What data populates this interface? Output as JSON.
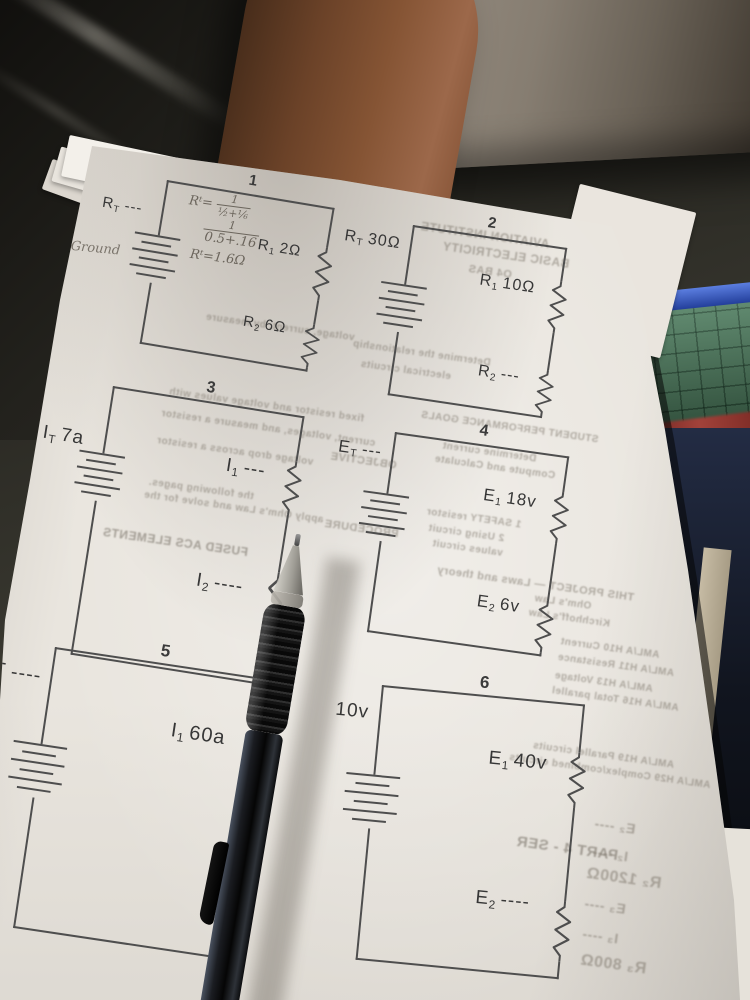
{
  "page": {
    "circuits": [
      {
        "number": "1",
        "left_label": {
          "base": "R",
          "sub": "T",
          "val": "---"
        },
        "top_resistor": {
          "base": "R",
          "sub": "1",
          "val": "2Ω"
        },
        "bottom_resistor": {
          "base": "R",
          "sub": "2",
          "val": "6Ω"
        },
        "handwriting": {
          "line1_lhs": "Rᵗ=",
          "frac1_num": "1",
          "frac1_den": "½+⅙",
          "frac2_num": "1",
          "frac2_den": "0.5+.16",
          "result": "Rᵗ=1.6Ω",
          "ground_note": "Ground"
        }
      },
      {
        "number": "2",
        "left_label": {
          "base": "R",
          "sub": "T",
          "val": "30Ω"
        },
        "top_resistor": {
          "base": "R",
          "sub": "1",
          "val": "10Ω"
        },
        "bottom_resistor": {
          "base": "R",
          "sub": "2",
          "val": "---"
        }
      },
      {
        "number": "3",
        "left_label": {
          "base": "I",
          "sub": "T",
          "val": "7a"
        },
        "top_resistor": {
          "base": "I",
          "sub": "1",
          "val": "---"
        },
        "bottom_resistor": {
          "base": "I",
          "sub": "2",
          "val": "----"
        }
      },
      {
        "number": "4",
        "left_label": {
          "base": "E",
          "sub": "T",
          "val": "---"
        },
        "top_resistor": {
          "base": "E",
          "sub": "1",
          "val": "18v"
        },
        "bottom_resistor": {
          "base": "E",
          "sub": "2",
          "val": "6v"
        }
      },
      {
        "number": "5",
        "left_label": {
          "base": "T",
          "sub": "",
          "val": "----"
        },
        "top_resistor": {
          "base": "I",
          "sub": "1",
          "val": "60a"
        },
        "bottom_resistor": {
          "base": "",
          "sub": "",
          "val": ""
        }
      },
      {
        "number": "6",
        "left_label": {
          "base": "",
          "sub": "",
          "val": "10v"
        },
        "top_resistor": {
          "base": "E",
          "sub": "1",
          "val": "40v"
        },
        "bottom_resistor": {
          "base": "E",
          "sub": "2",
          "val": "----"
        }
      }
    ],
    "ghost_texts": [
      "AVIATION INSTITUTE",
      "BASIC ELECTRICITY",
      "O4 BAS",
      "Determine the relationship",
      "electrical circuits",
      "voltage, current, by measure",
      "fixed resistor and voltage values with",
      "current, voltages, and measure a resistor",
      "voltage drop across a resistor",
      "the following pages.",
      "apply Ohm's Law and solve for the",
      "FUSED ACS ELEMENTS",
      "STUDENT PERFORMANCE GOALS",
      "Determine current",
      "Compute and Calculate",
      "OBJECTIVE",
      "PROCEDURE",
      "1  SAFETY resistor",
      "2  Using circuit",
      "values circuit",
      "THIS PROJECT — Laws and theory",
      "Ohm's Law",
      "Kirchhoff's Law",
      "AML/A H10   Current",
      "AML/A H11   Resistance",
      "AML/A H13   Voltage",
      "AML/A H16   Total parallel",
      "AML/A H19   Parallel circuits",
      "AML/A H29   Complex/combined circuits",
      "PART 4 - SER",
      "E₂ ----",
      "I₂ ----",
      "R₂ 1200Ω",
      "E₃ ----",
      "I₃ ----",
      "R₃ 800Ω"
    ]
  },
  "colors": {
    "paper": "#e9e5de",
    "circuit_line": "#4e4e4e",
    "desk": "#23221c",
    "skin": "#855434",
    "pen": "#0b0b0b",
    "seat_object": "#867d71",
    "blue_object": "#24409c",
    "green_object": "#4b7a5c",
    "red_streak": "#a2423a"
  }
}
